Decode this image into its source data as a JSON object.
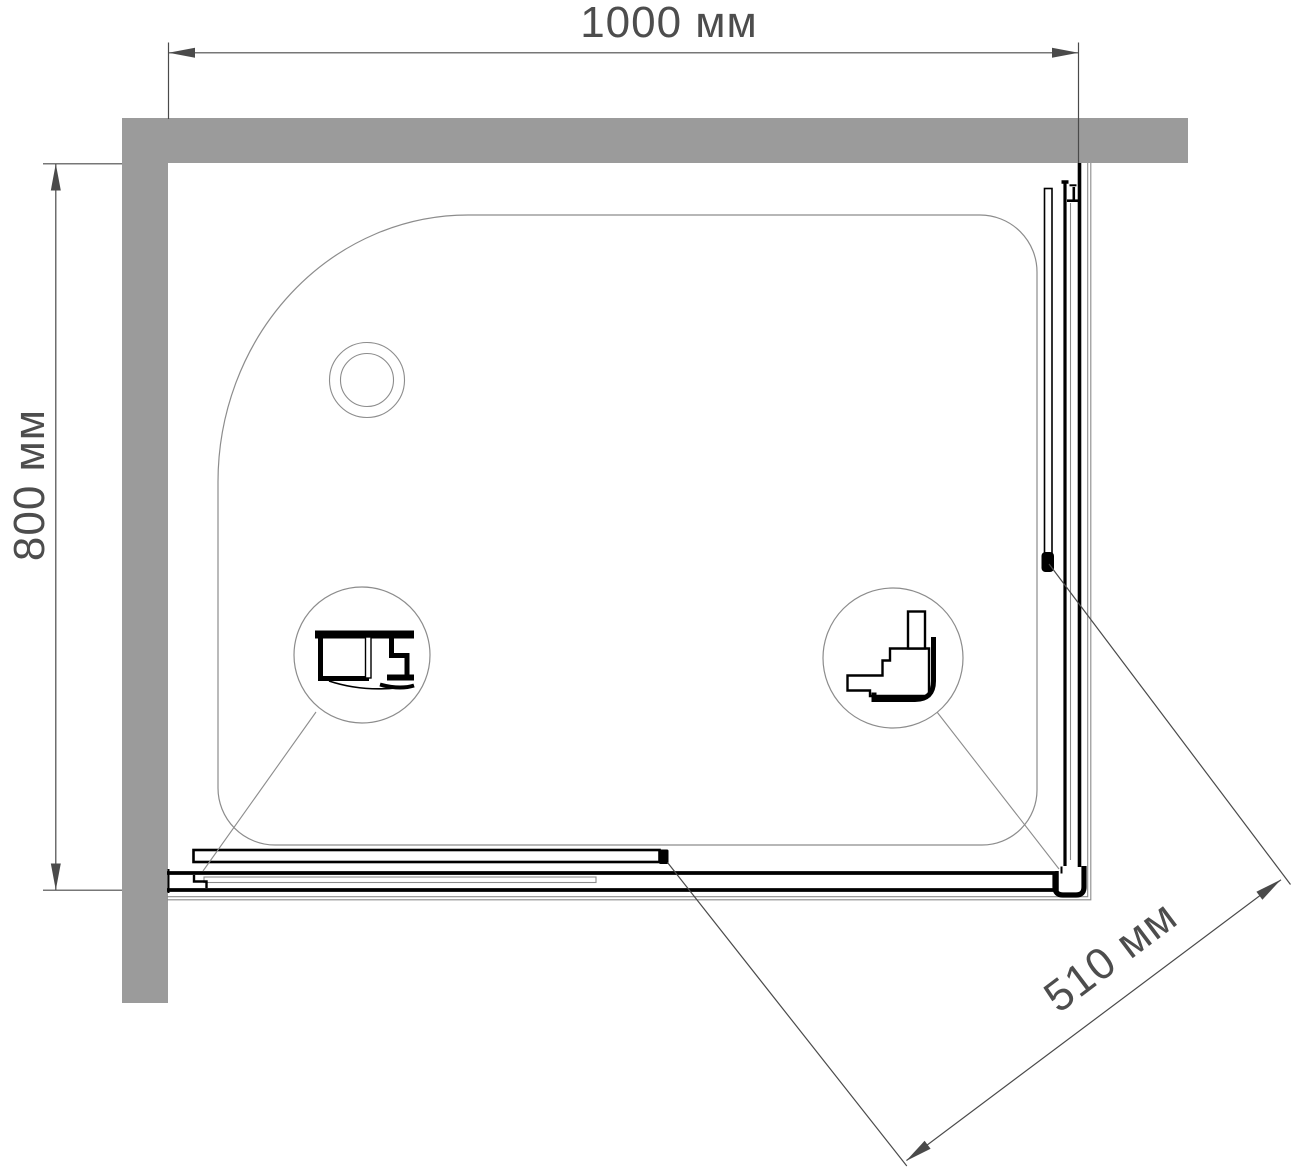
{
  "drawing": {
    "dimensions": {
      "top_width": {
        "label": "1000 мм",
        "value": 1000,
        "unit": "мм"
      },
      "left_depth": {
        "label": "800 мм",
        "value": 800,
        "unit": "мм"
      },
      "diagonal_opening": {
        "label": "510 мм",
        "value": 510,
        "unit": "мм"
      }
    },
    "colors": {
      "wall_fill": "#9b9b9b",
      "profile_line": "#000000",
      "tray_line": "#8c8c8c",
      "dimension_line": "#4a4a4a",
      "text": "#4d4d4d",
      "background": "#ffffff"
    }
  }
}
